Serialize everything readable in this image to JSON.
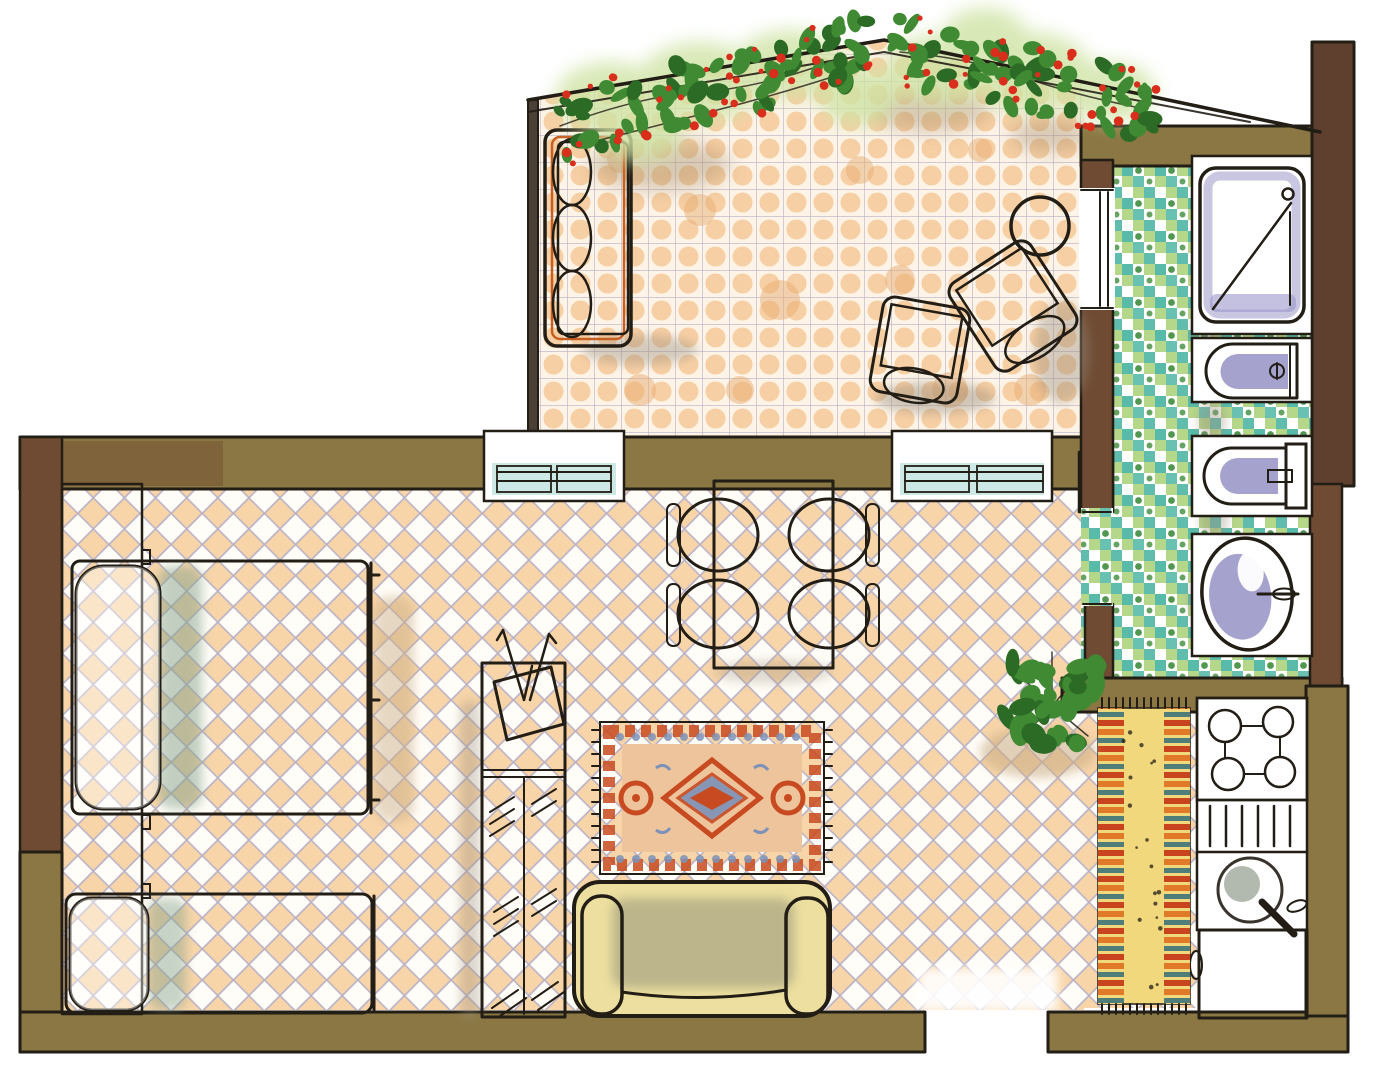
{
  "plan": {
    "type": "hand-drawn-apartment-floor-plan",
    "rooms": [
      {
        "id": "terrace",
        "floor": "peach-square-tile",
        "furniture": [
          "outdoor-sofa",
          "armchair-1",
          "armchair-2",
          "round-side-table"
        ],
        "decor": [
          "flowering-vine-left",
          "flowering-vine-right",
          "pergola-lines"
        ]
      },
      {
        "id": "bathroom",
        "floor": "green-mosaic-tile",
        "fixtures": [
          "shower-tray",
          "bidet",
          "toilet",
          "washbasin"
        ],
        "doors": [
          "terrace-door",
          "room-door"
        ]
      },
      {
        "id": "kitchen-nook",
        "fixtures": [
          "hob-4-burners",
          "drainboard",
          "round-sink",
          "blue-counter"
        ],
        "decor": [
          "runner-rug"
        ]
      },
      {
        "id": "studio-room",
        "floor": "peach-lattice-tile",
        "furniture": [
          "headboard-panel",
          "double-bed",
          "single-bed",
          "wardrobe-tv-column",
          "dining-table",
          "dining-chair-1",
          "dining-chair-2",
          "dining-chair-3",
          "dining-chair-4",
          "area-rug",
          "sofa",
          "potted-plant"
        ],
        "windows": [
          "terrace-window-left",
          "terrace-window-right"
        ],
        "entry": "bottom-wall-opening"
      }
    ]
  },
  "colors": {
    "ink": "#221d15",
    "paper": "#ffffff",
    "wall_olive": "#8a7743",
    "wall_brown": "#6f4b33",
    "wall_brown_dark": "#5f3f2d",
    "terrace_wall": "#4a4036",
    "terrace_tile": "#f5c693",
    "floor_peach": "#f6cf9e",
    "lattice_line": "#b7b0c6",
    "bath_teal": "#4fb6a4",
    "bath_green": "#b5d78a",
    "bath_dot": "#3e8c3c",
    "orange": "#e6782a",
    "orange_deep": "#c65f1f",
    "yellow_cushion": "#f2c937",
    "cushion_gray": "#b9c6c4",
    "bed_blue": "#a9c7e5",
    "bed_stripe": "#8fb2d8",
    "bed_shadow": "#85a18b",
    "chair_yellow": "#ddb71e",
    "chair_back": "#a84c28",
    "sofa_cream": "#ecdf9f",
    "sofa_shade": "#8d8d78",
    "rug_red": "#c84a20",
    "rug_orange": "#dd8a52",
    "rug_field": "#eec49c",
    "rug_blue": "#7d92b8",
    "runner_yellow": "#f2d87c",
    "runner_orange": "#e07a28",
    "runner_teal": "#4f7d7a",
    "runner_red": "#c8441f",
    "fixture_lavender": "#9b98c9",
    "fixture_lavender_light": "#c9c7e2",
    "sink_gray": "#9aa696",
    "stove_teal": "#59c4b2",
    "counter_blue": "#3c98d4",
    "window_teal": "#2fa3ad",
    "plant_green": "#3f8a33",
    "plant_dark": "#2c6b26",
    "plant_light": "#cfe3a4",
    "flower_red": "#d92e1b",
    "shadow_tan": "#c9ab83",
    "shadow_gray": "#9a8d7c"
  }
}
